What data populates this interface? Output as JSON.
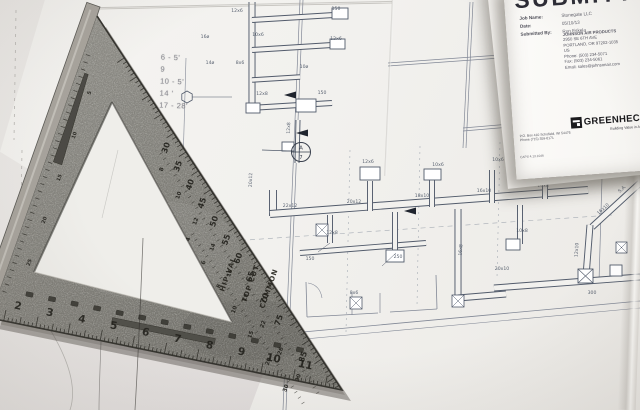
{
  "submittal": {
    "title": "SUBMITTAL",
    "fields": [
      {
        "label": "Job Name:",
        "value": "Stonegate LLC"
      },
      {
        "label": "Date:",
        "value": "05/10/13"
      },
      {
        "label": "Submitted By:",
        "value": "Ron Eskela"
      }
    ],
    "address_lines": [
      "JOHNSON AIR PRODUCTS",
      "2950 SE 6TH AVE",
      "PORTLAND, OR 97202-1035",
      "US",
      "Phone: (503) 234-5071",
      "Fax: (503) 234-5061",
      "Email: sales@johnsonair.com"
    ],
    "greenheck": {
      "name": "GREENHECK",
      "tagline": "Building Value in Air.",
      "address": "P.O. Box 410  Schofield, WI 54476",
      "phone": "Phone (715) 359-6171",
      "caps": "CAPS 4.13.1046"
    }
  },
  "handwritten_notes": [
    "6 - 5'",
    "9",
    "10 - 5'",
    "14 '",
    "17 - 28'"
  ],
  "speed_square": {
    "inch_numbers": [
      "2",
      "3",
      "4",
      "5",
      "6",
      "7",
      "8",
      "9",
      "10",
      "11"
    ],
    "degree_numbers": [
      "30",
      "35",
      "40",
      "45",
      "50",
      "55",
      "60",
      "65",
      "70",
      "75",
      "85"
    ],
    "common_numbers": [
      "8",
      "10",
      "12",
      "14",
      "16",
      "18",
      "22",
      "26",
      "30"
    ],
    "hipval_numbers": [
      "4",
      "6",
      "8",
      "10",
      "15",
      "20",
      "30"
    ],
    "leg_numbers": [
      "5",
      "10",
      "15",
      "20",
      "25"
    ],
    "scale_labels": {
      "hip_val": "HIP-VAL",
      "top_cut": "TOP CUT",
      "common": "COMMON"
    }
  },
  "blueprint": {
    "colors": {
      "duct": "#525b6b",
      "wall": "#828896",
      "paper": "#f2f1ee",
      "label": "#4b5565",
      "faint": "#b8b6b2"
    },
    "callout": {
      "letter": "A",
      "number": "7"
    },
    "labels": [
      {
        "x": 237,
        "y": 12,
        "t": "12x6"
      },
      {
        "x": 336,
        "y": 10,
        "t": "150"
      },
      {
        "x": 258,
        "y": 36,
        "t": "10x6"
      },
      {
        "x": 336,
        "y": 40,
        "t": "12x6"
      },
      {
        "x": 240,
        "y": 64,
        "t": "8x6"
      },
      {
        "x": 304,
        "y": 68,
        "t": "10ø"
      },
      {
        "x": 262,
        "y": 95,
        "t": "12x8"
      },
      {
        "x": 322,
        "y": 94,
        "t": "150"
      },
      {
        "x": 205,
        "y": 38,
        "t": "16ø"
      },
      {
        "x": 210,
        "y": 64,
        "t": "14ø"
      },
      {
        "x": 290,
        "y": 128,
        "t": "12x8",
        "r": -88
      },
      {
        "x": 368,
        "y": 163,
        "t": "12x6"
      },
      {
        "x": 438,
        "y": 166,
        "t": "10x6"
      },
      {
        "x": 498,
        "y": 161,
        "t": "10x6"
      },
      {
        "x": 252,
        "y": 180,
        "t": "20x12",
        "r": -88
      },
      {
        "x": 290,
        "y": 207,
        "t": "22x12"
      },
      {
        "x": 354,
        "y": 203,
        "t": "20x12"
      },
      {
        "x": 422,
        "y": 197,
        "t": "18x10"
      },
      {
        "x": 484,
        "y": 192,
        "t": "16x10"
      },
      {
        "x": 543,
        "y": 187,
        "t": "14x8"
      },
      {
        "x": 332,
        "y": 234,
        "t": "12x8"
      },
      {
        "x": 398,
        "y": 258,
        "t": "250"
      },
      {
        "x": 462,
        "y": 250,
        "t": "16x8",
        "r": -86
      },
      {
        "x": 522,
        "y": 232,
        "t": "10x8"
      },
      {
        "x": 310,
        "y": 260,
        "t": "150"
      },
      {
        "x": 354,
        "y": 294,
        "t": "8x6"
      },
      {
        "x": 604,
        "y": 210,
        "t": "16x10",
        "r": -42
      },
      {
        "x": 623,
        "y": 190,
        "t": "S.A.",
        "r": -42
      },
      {
        "x": 578,
        "y": 250,
        "t": "12x10",
        "r": -86
      },
      {
        "x": 502,
        "y": 270,
        "t": "20x10"
      },
      {
        "x": 592,
        "y": 294,
        "t": "300"
      },
      {
        "x": 612,
        "y": 172,
        "t": "RTU-1"
      }
    ]
  }
}
